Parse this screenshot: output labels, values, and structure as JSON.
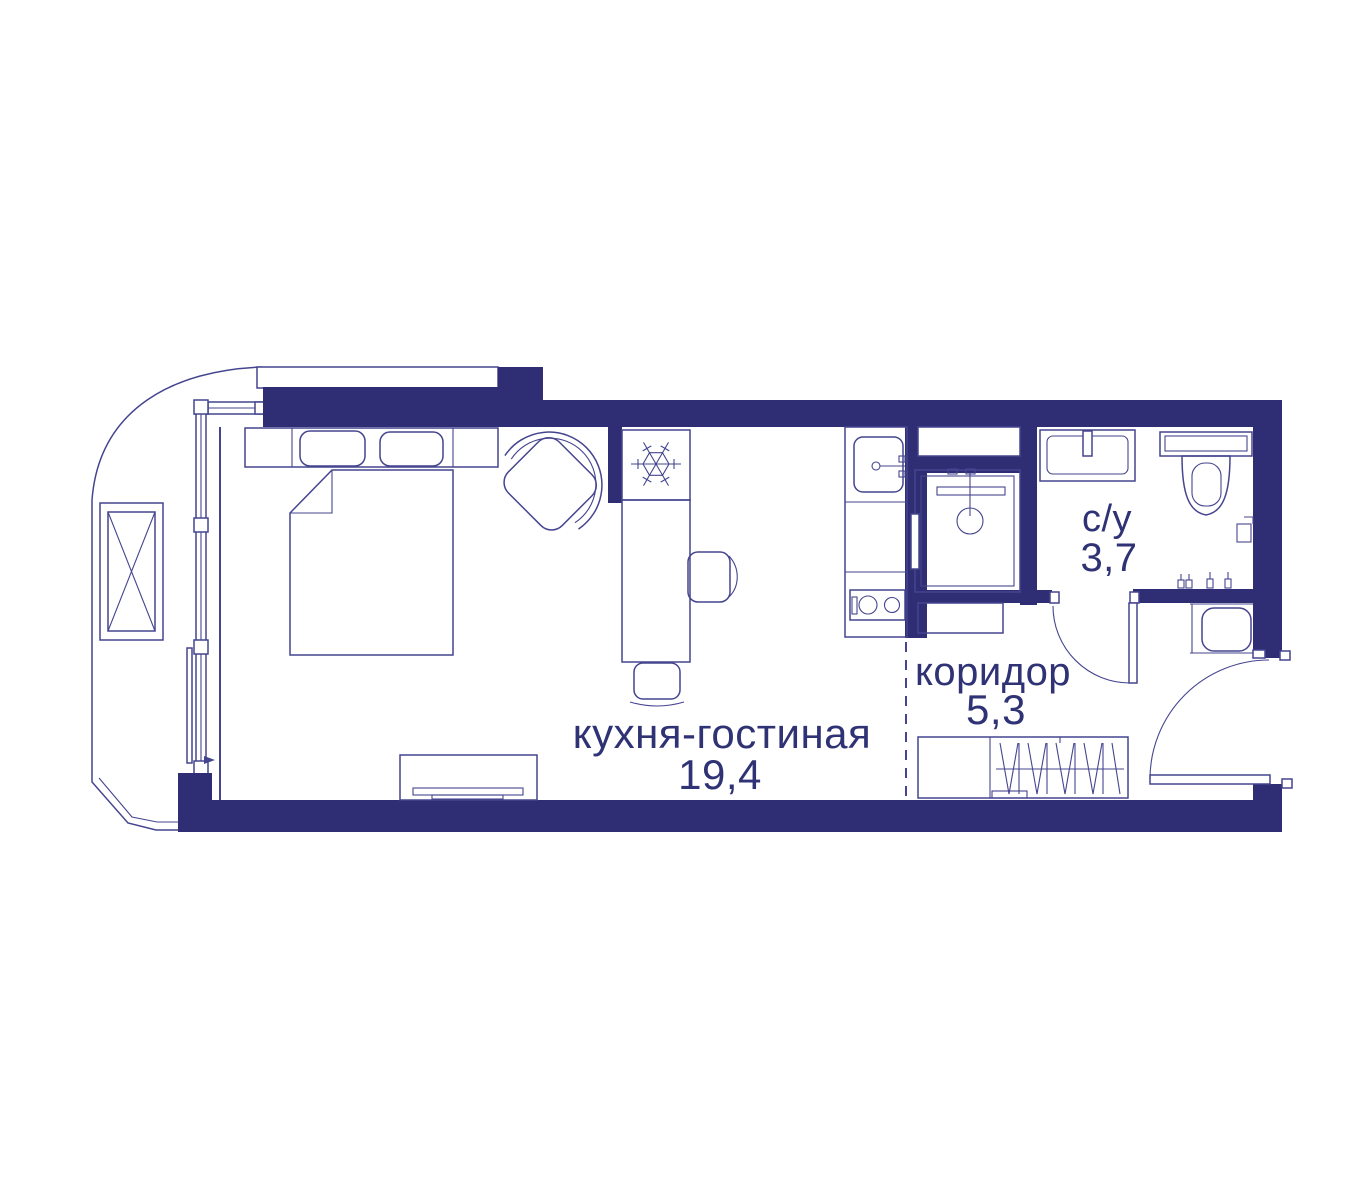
{
  "plan_type": "apartment-floor-plan",
  "colors": {
    "wall": "#2f2d74",
    "line": "#45458f",
    "text": "#2f3274",
    "bg": "#ffffff"
  },
  "rooms": [
    {
      "id": "kitchen-living",
      "label": "кухня-гостиная",
      "area": "19,4"
    },
    {
      "id": "corridor",
      "label": "коридор",
      "area": "5,3"
    },
    {
      "id": "bathroom",
      "label": "с/у",
      "area": "3,7"
    }
  ],
  "icons": {
    "fridge_icon": "snowflake",
    "wardrobe_icon": "hanger-zigzag",
    "door_icon": "quarter-arc-swing"
  },
  "fixtures": [
    "balcony",
    "window-wall",
    "double-bed",
    "pillows",
    "bedside-console",
    "armchair",
    "fridge",
    "kitchen-island",
    "dining-chair",
    "stool",
    "kitchen-counter",
    "kitchen-sink",
    "stove",
    "tv-stand",
    "shower-cabin",
    "wall-niche",
    "washbasin",
    "toilet",
    "toilet-paper-holder",
    "towel-hooks",
    "hallway-cabinet",
    "wardrobe",
    "bathroom-door",
    "entrance-door",
    "balcony-door"
  ]
}
